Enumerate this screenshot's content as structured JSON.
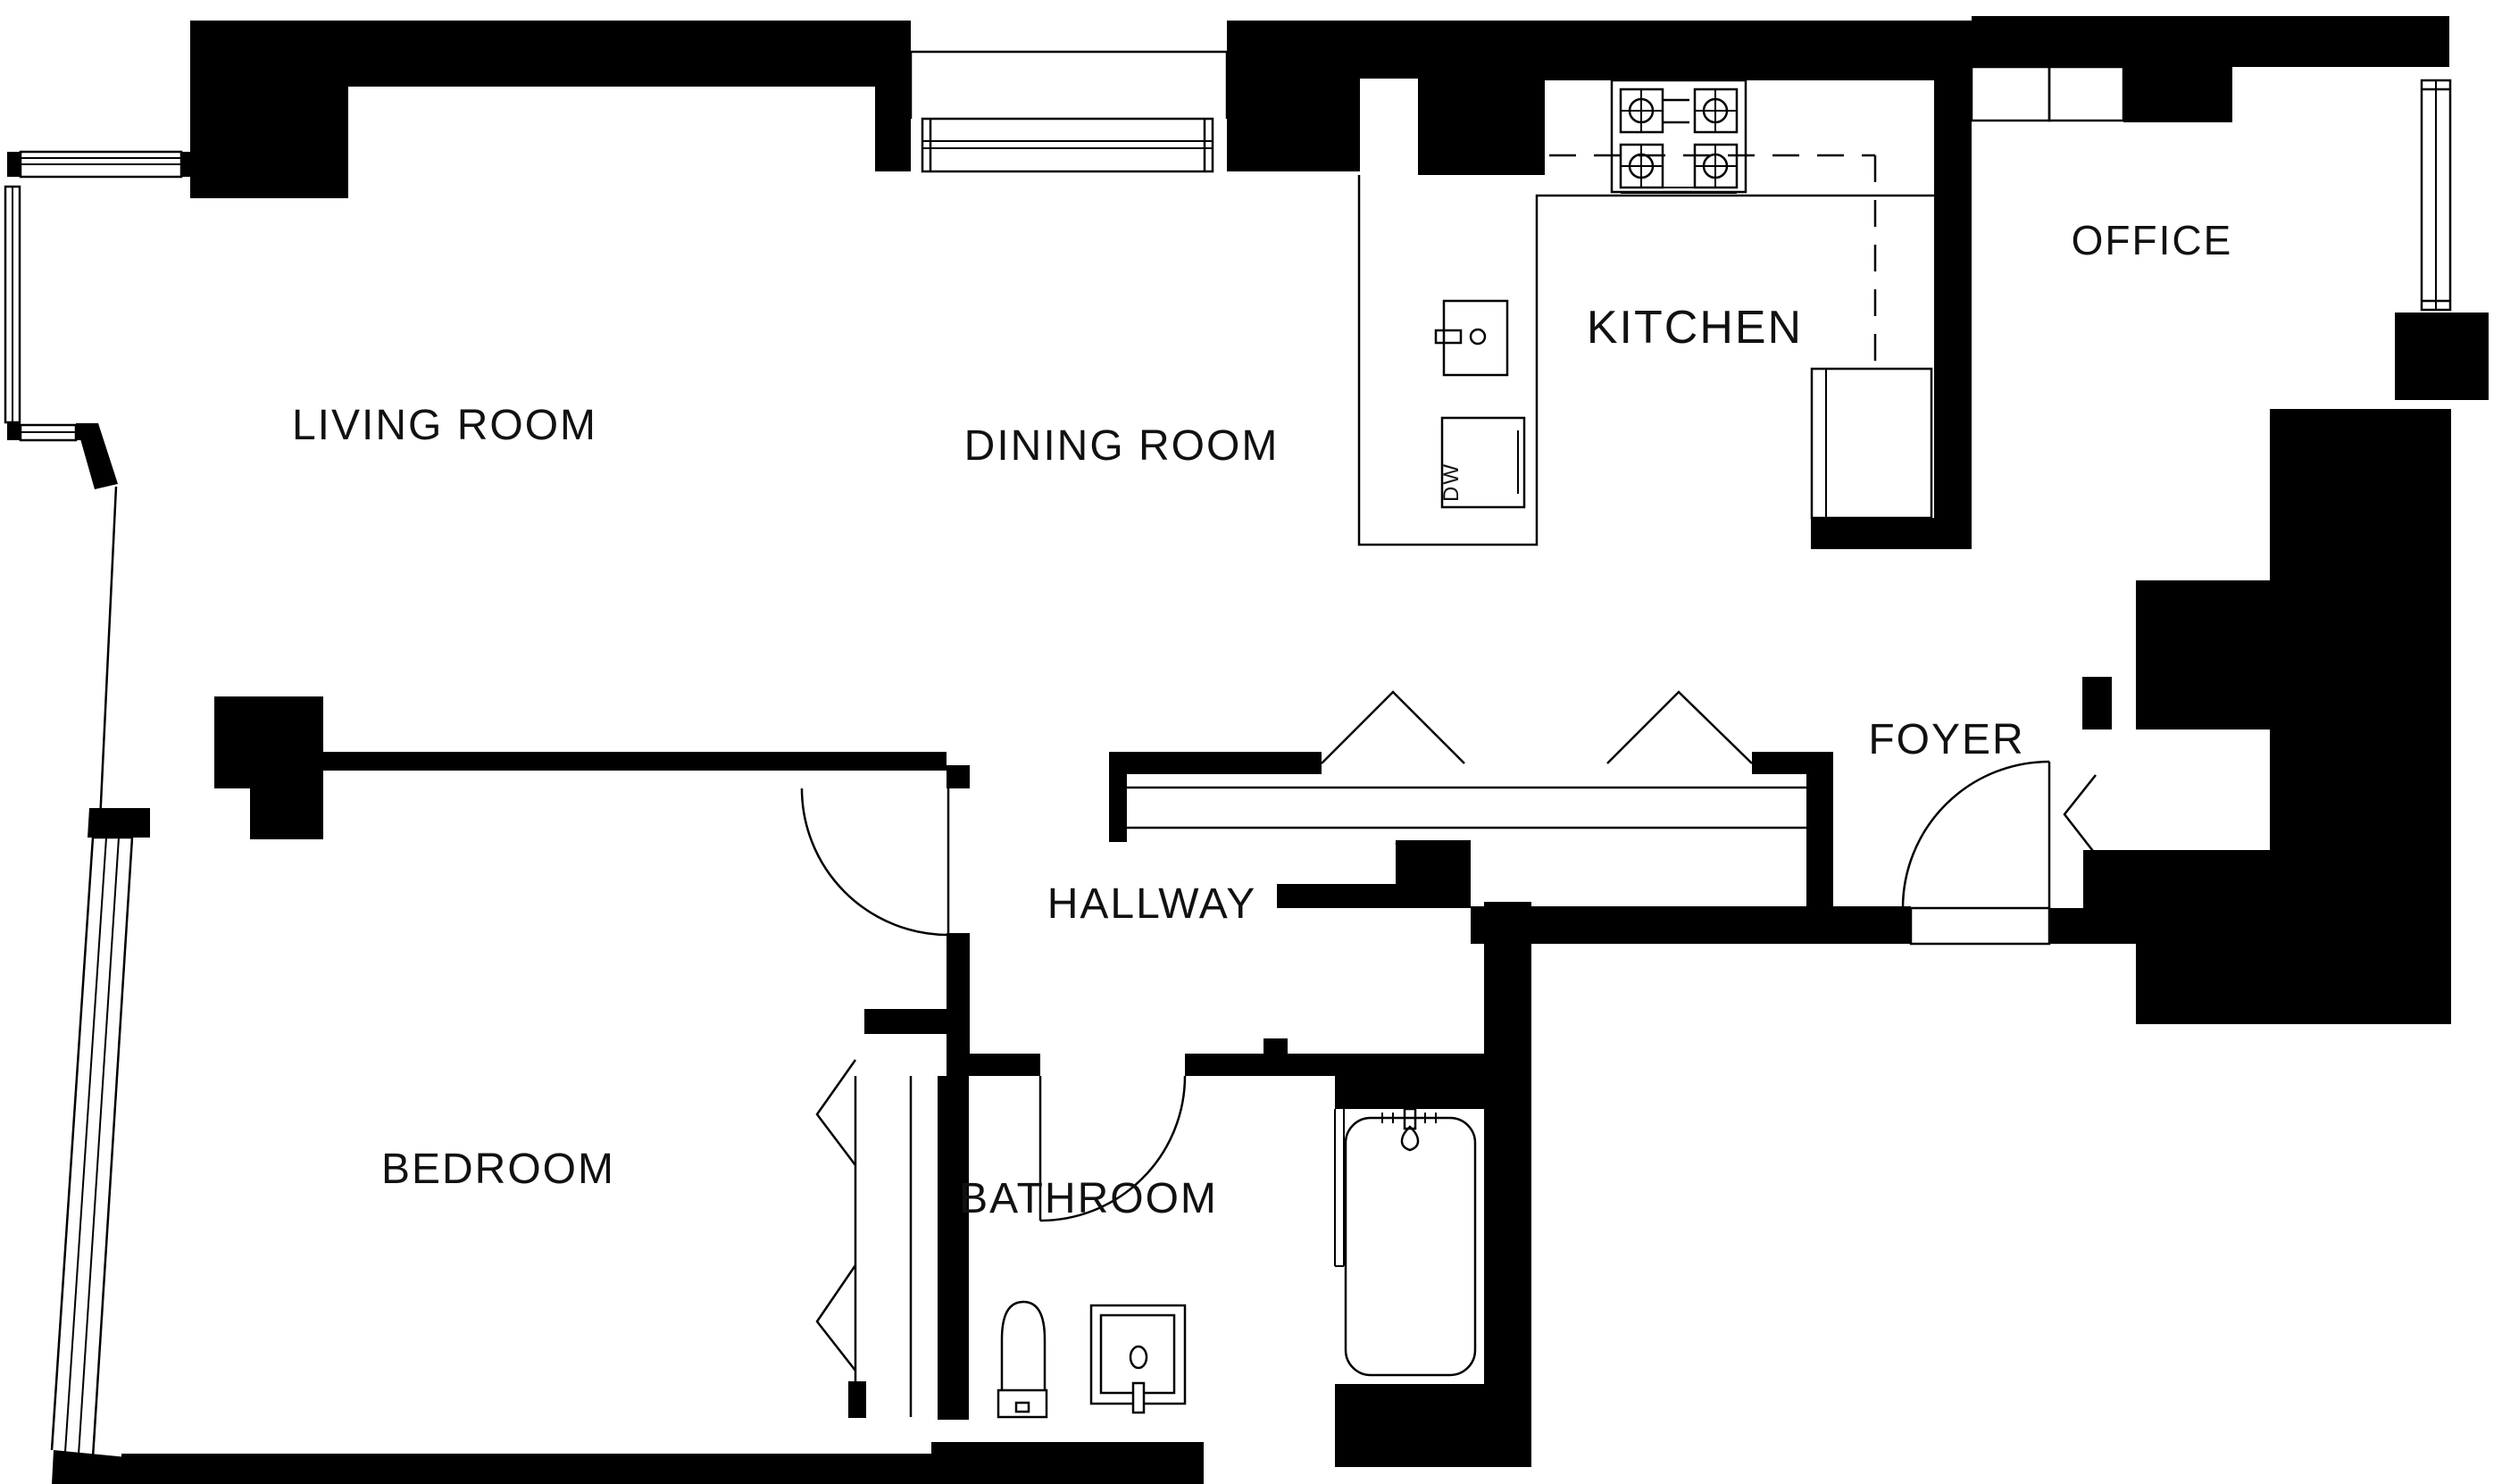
{
  "plan": {
    "type": "apartment-floor-plan",
    "colors": {
      "background": "#ffffff",
      "walls": "#000000",
      "lines": "#000000",
      "text": "#111111"
    },
    "rooms": [
      {
        "id": "living-room",
        "label": "LIVING ROOM"
      },
      {
        "id": "dining-room",
        "label": "DINING ROOM"
      },
      {
        "id": "kitchen",
        "label": "KITCHEN"
      },
      {
        "id": "office",
        "label": "OFFICE"
      },
      {
        "id": "foyer",
        "label": "FOYER"
      },
      {
        "id": "hallway",
        "label": "HALLWAY"
      },
      {
        "id": "bedroom",
        "label": "BEDROOM"
      },
      {
        "id": "bathroom",
        "label": "BATHROOM"
      }
    ],
    "fixtures": {
      "dishwasher_label": "DW",
      "stove_burners": 4,
      "items": [
        "stove",
        "kitchen-sink",
        "dishwasher",
        "refrigerator",
        "toilet",
        "bathroom-sink",
        "bathtub"
      ]
    },
    "symbols": [
      "swing-door",
      "bifold-closet-door",
      "window",
      "gas-dashed-line"
    ]
  }
}
